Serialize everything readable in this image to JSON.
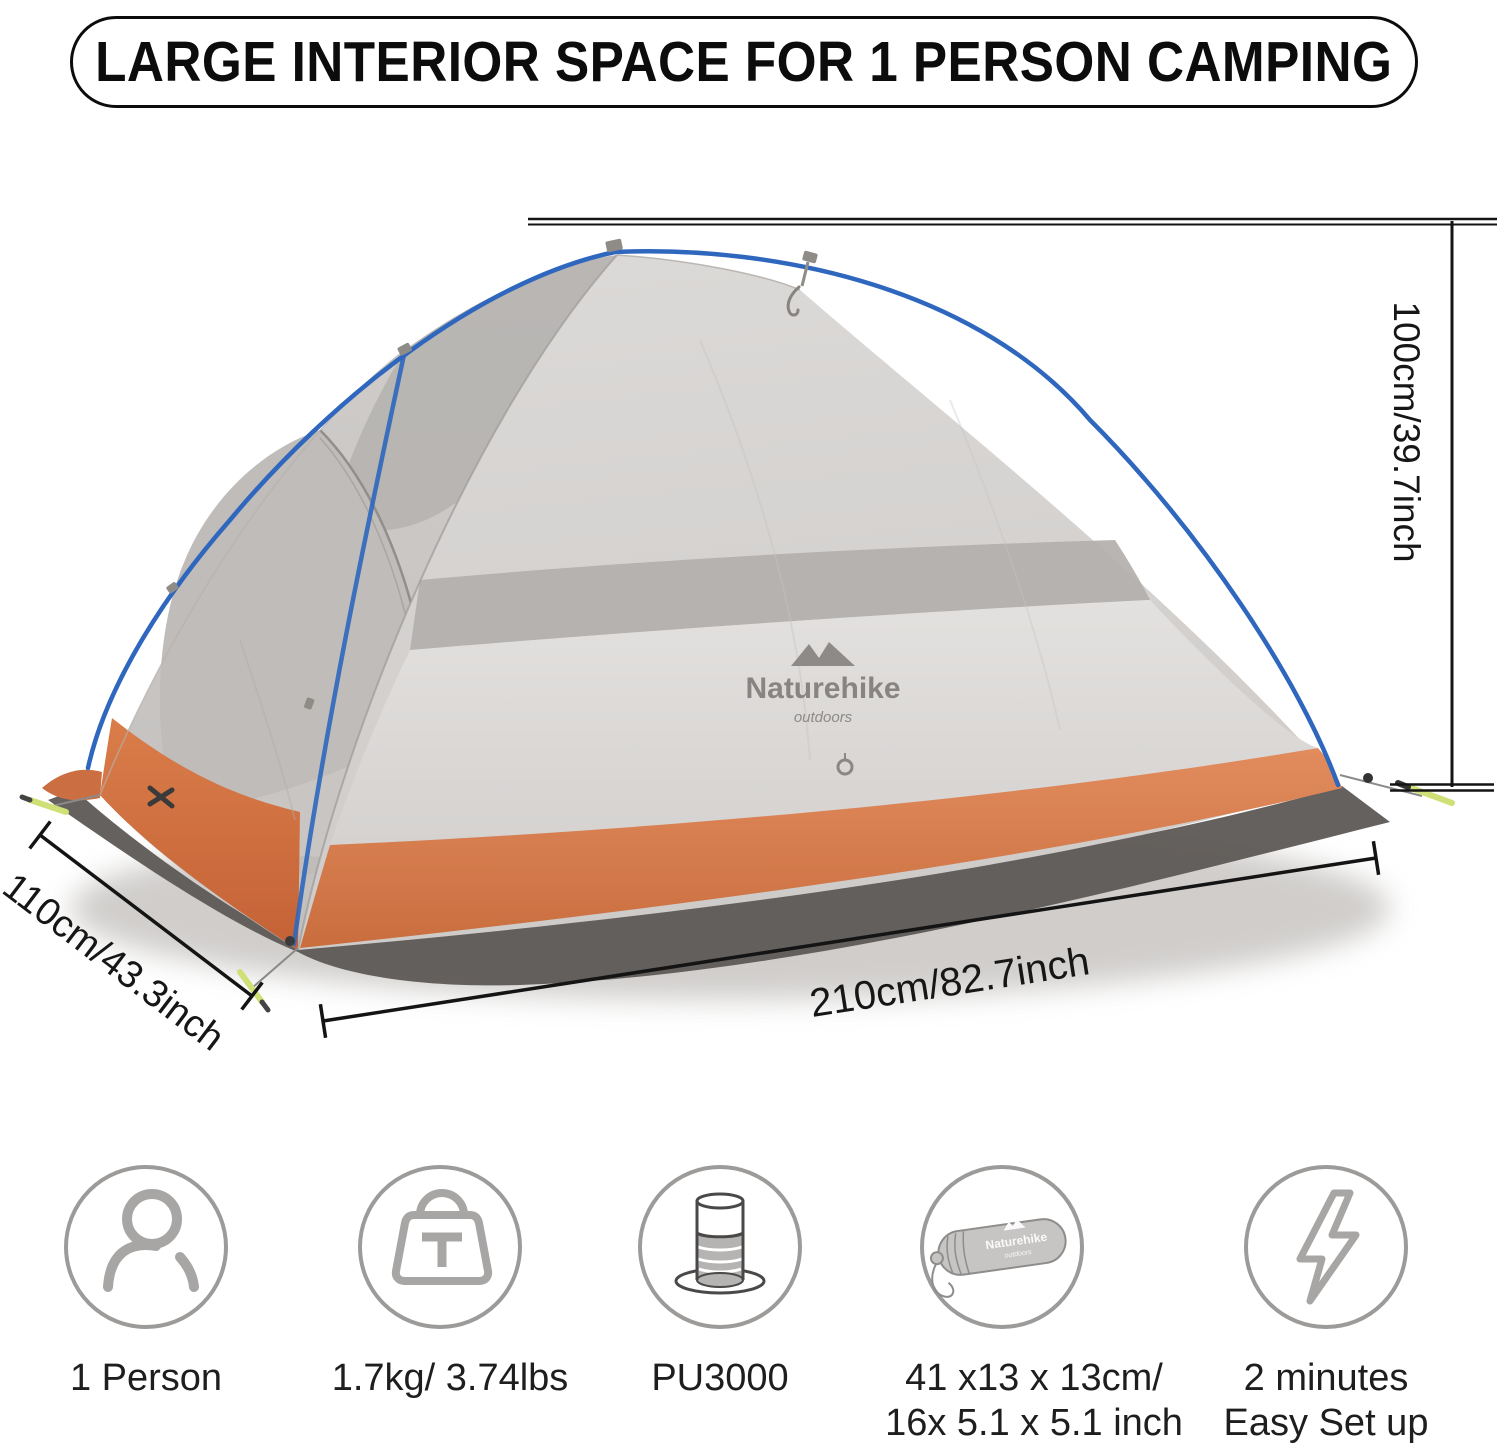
{
  "banner": {
    "title": "LARGE INTERIOR SPACE FOR 1 PERSON CAMPING"
  },
  "dimensions": {
    "height_label": "100cm/39.7inch",
    "width_label": "110cm/43.3inch",
    "length_label": "210cm/82.7inch"
  },
  "tent": {
    "brand": "Naturehike",
    "brand_sub": "outdoors",
    "colors": {
      "fly_gray": "#d6d3d1",
      "mesh_gray": "#b2afad",
      "base_orange": "#dd8155",
      "pole_blue": "#2e67bd",
      "groundsheet": "#5d5955",
      "stake_green": "#cfe077"
    }
  },
  "features": [
    {
      "icon": "person-icon",
      "line1": "1 Person",
      "line2": ""
    },
    {
      "icon": "weight-icon",
      "line1": "1.7kg/ 3.74lbs",
      "line2": ""
    },
    {
      "icon": "waterproof-rating-icon",
      "line1": "PU3000",
      "line2": ""
    },
    {
      "icon": "packed-size-icon",
      "line1": "41 x13 x 13cm/",
      "line2": "16x 5.1 x 5.1 inch"
    },
    {
      "icon": "quick-setup-icon",
      "line1": "2 minutes",
      "line2": "Easy Set up"
    }
  ]
}
